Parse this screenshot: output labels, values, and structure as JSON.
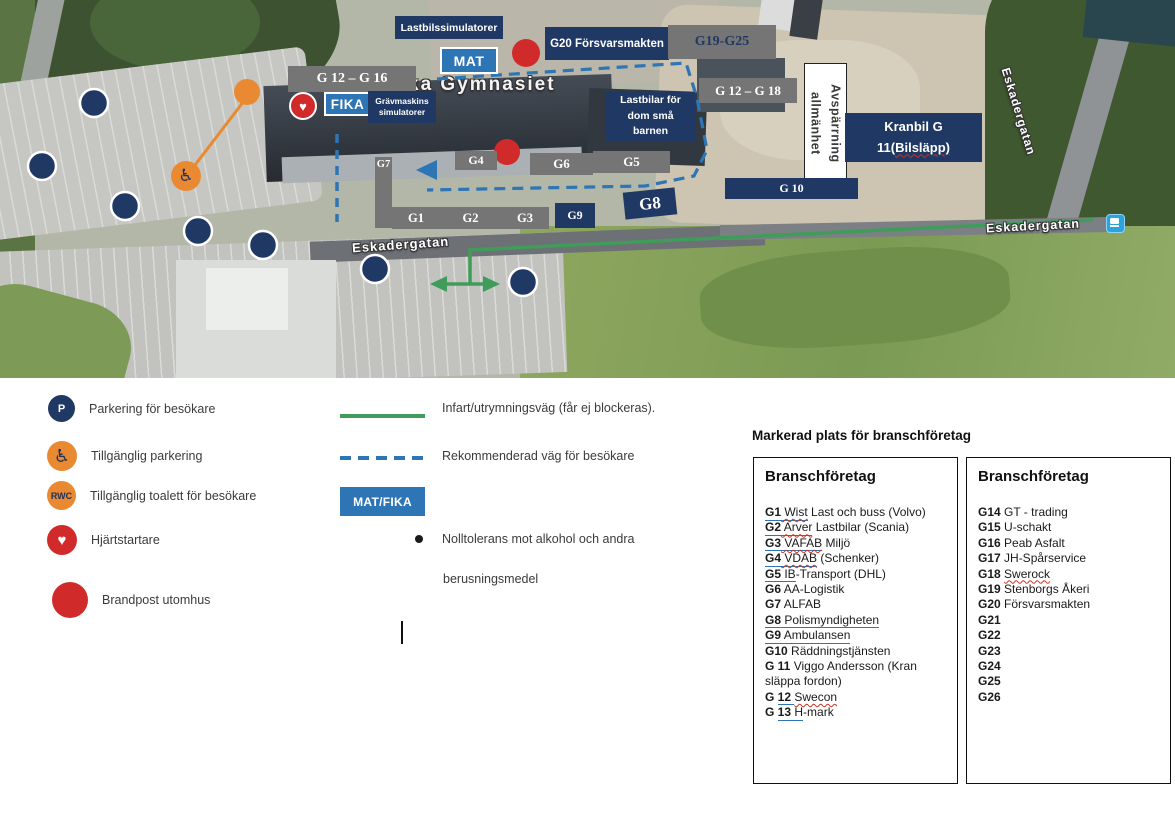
{
  "map": {
    "place_label": "ka Gymnasiet",
    "streets": {
      "left": "Eskadergatan",
      "right": "Eskadergatan",
      "bottom": "Eskadergatan"
    },
    "boxes": {
      "lastbilssimulatorer": "Lastbilssimulatorer",
      "mat": "MAT",
      "fika": "FIKA",
      "g20": "G20 Försvarsmakten",
      "g19_g25": "G19-G25",
      "g12_g16": "G 12 – G 16",
      "g12_g18": "G 12 – G 18",
      "gravmaskins": "Grävmaskins\nsimulatorer",
      "lastbilar_barn": "Lastbilar för\ndom små\nbarnen",
      "avsparrning": "Avspärrning allmänhet",
      "kranbil_line1": "Kranbil G",
      "kranbil_line2a": "11(",
      "kranbil_line2b": "Bilsläpp)",
      "g10": "G 10",
      "g9": "G9",
      "g8": "G8",
      "g7": "G7",
      "g6": "G6",
      "g5": "G5",
      "g4": "G4",
      "g1": "G1",
      "g2": "G2",
      "g3": "G3"
    },
    "colors": {
      "navy": "#1f3864",
      "gray": "#757575",
      "blue": "#2e75b6",
      "green_route": "#3f9c5a",
      "orange": "#e98a33",
      "red": "#d12a2a"
    }
  },
  "legend": {
    "p_letter": "P",
    "rwc_letter": "RWC",
    "heart_glyph": "♥",
    "wheelchair_glyph": "♿",
    "parkering": "Parkering för besökare",
    "tillganglig_parkering": "Tillgänglig parkering",
    "tillganglig_toalett": "Tillgänglig toalett för besökare",
    "hjartstartare": "Hjärtstartare",
    "brandpost": "Brandpost utomhus",
    "infart": "Infart/utrymningsväg (får ej blockeras).",
    "rekommenderad": "Rekommenderad väg för besökare",
    "mat_fika": "MAT/FIKA",
    "nolltolerans_line1": "Nolltolerans mot alkohol och andra",
    "nolltolerans_line2": "berusningsmedel"
  },
  "companies": {
    "section_title": "Markerad plats för branschföretag",
    "box1_title": "Branschföretag",
    "box2_title": "Branschföretag",
    "box1": [
      [
        {
          "t": "G1",
          "b": 1,
          "u": 1
        },
        {
          "t": " Wist",
          "u": 1,
          "w": 1
        },
        {
          "t": " Last och buss (Volvo)"
        }
      ],
      [
        {
          "t": "G2",
          "b": 1,
          "u": 1
        },
        {
          "t": " Arver",
          "u": 1,
          "w": 1
        },
        {
          "t": " Lastbilar (Scania)"
        }
      ],
      [
        {
          "t": "G3",
          "b": 1,
          "u": 1
        },
        {
          "t": " VAFAB",
          "u": 1,
          "w": 1
        },
        {
          "t": " Miljö"
        }
      ],
      [
        {
          "t": "G4",
          "b": 1,
          "u": 1
        },
        {
          "t": " VDAB",
          "u": 1,
          "w": 1
        },
        {
          "t": " (Schenker)"
        }
      ],
      [
        {
          "t": "G5",
          "b": 1,
          "u": 1
        },
        {
          "t": " IB",
          "u": 1
        },
        {
          "t": "-Transport (DHL)"
        }
      ],
      [
        {
          "t": "G6",
          "b": 1
        },
        {
          "t": " AA-Logistik"
        }
      ],
      [
        {
          "t": "G7",
          "b": 1
        },
        {
          "t": " ALFAB"
        }
      ],
      [
        {
          "t": "G8",
          "b": 1,
          "u": 1
        },
        {
          "t": " Polismyndigheten",
          "u": 1
        }
      ],
      [
        {
          "t": "G9",
          "b": 1,
          "u": 1
        },
        {
          "t": " Ambulansen",
          "u": 1
        }
      ],
      [
        {
          "t": "G10",
          "b": 1
        },
        {
          "t": " Räddningstjänsten"
        }
      ],
      [
        {
          "t": "G 11",
          "b": 1
        },
        {
          "t": " Viggo Andersson (Kran släppa fordon)"
        }
      ],
      [
        {
          "t": "G ",
          "b": 1
        },
        {
          "t": "12 ",
          "b": 1,
          "u": 1
        },
        {
          "t": "Swecon",
          "w": 1
        }
      ],
      [
        {
          "t": "G ",
          "b": 1
        },
        {
          "t": "13 ",
          "b": 1,
          "u": 1
        },
        {
          "t": "H",
          "u": 1
        },
        {
          "t": "-mark"
        }
      ]
    ],
    "box2": [
      [
        {
          "t": "G14",
          "b": 1
        },
        {
          "t": " GT - trading"
        }
      ],
      [
        {
          "t": "G15",
          "b": 1
        },
        {
          "t": " U-schakt"
        }
      ],
      [
        {
          "t": "G16",
          "b": 1
        },
        {
          "t": " Peab Asfalt"
        }
      ],
      [
        {
          "t": "G17",
          "b": 1
        },
        {
          "t": " JH-Spårservice"
        }
      ],
      [
        {
          "t": "G18",
          "b": 1
        },
        {
          "t": " "
        },
        {
          "t": "Swerock",
          "w": 1
        }
      ],
      [
        {
          "t": "G19",
          "b": 1
        },
        {
          "t": " Stenborgs Åkeri"
        }
      ],
      [
        {
          "t": "G20",
          "b": 1
        },
        {
          "t": " Försvarsmakten"
        }
      ],
      [
        {
          "t": "G21",
          "b": 1
        }
      ],
      [
        {
          "t": "G22",
          "b": 1
        }
      ],
      [
        {
          "t": "G23",
          "b": 1
        }
      ],
      [
        {
          "t": "G24",
          "b": 1
        }
      ],
      [
        {
          "t": "G25",
          "b": 1
        }
      ],
      [
        {
          "t": "G26",
          "b": 1
        }
      ]
    ]
  }
}
